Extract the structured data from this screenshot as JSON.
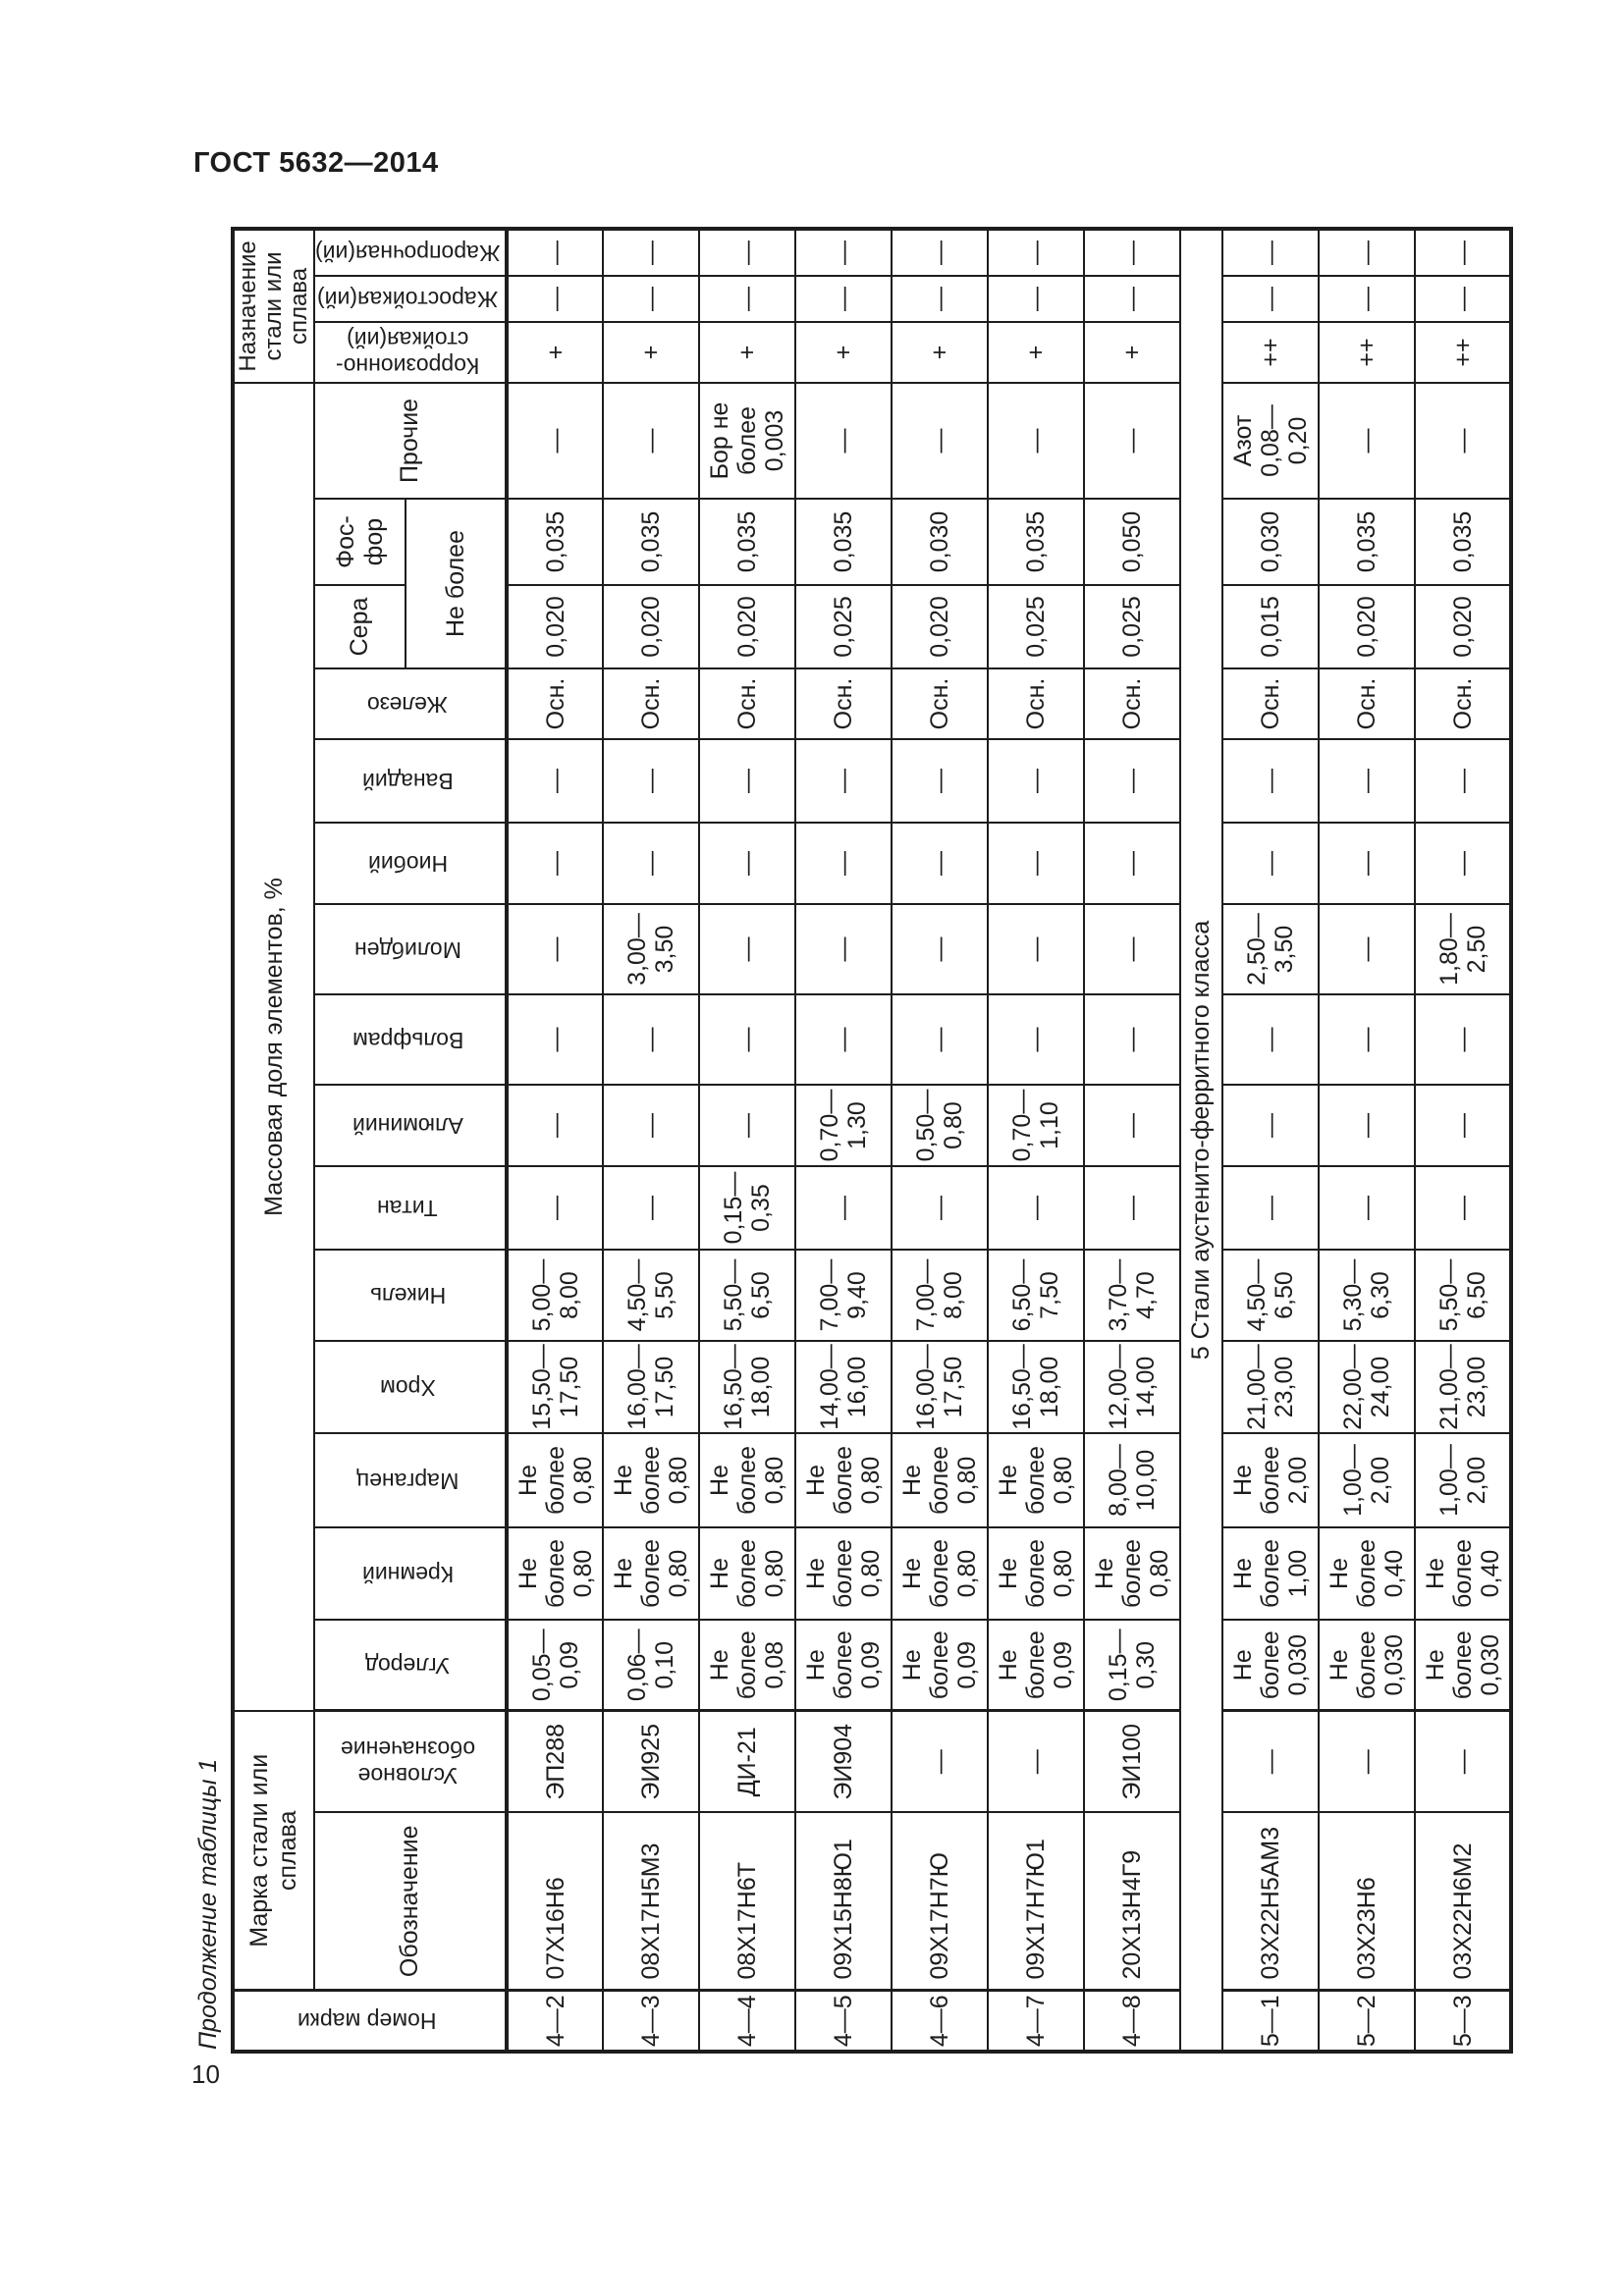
{
  "page": {
    "doc_number": "ГОСТ 5632—2014",
    "page_number": "10",
    "continuation_label": "Продолжение таблицы 1"
  },
  "table": {
    "headers": {
      "num": "Номер марки",
      "mark_group": "Марка стали или сплава",
      "oboznachenie": "Обозначение",
      "uslovnoe": "Условное\nобозначение",
      "mass_group": "Массовая доля элементов, %",
      "uglerod": "Углерод",
      "kremniy": "Кремний",
      "marganec": "Марганец",
      "hrom": "Хром",
      "nikel": "Никель",
      "titan": "Титан",
      "aluminiy": "Алюминий",
      "volfram": "Вольфрам",
      "molibden": "Молибден",
      "niobiy": "Ниобий",
      "vanadiy": "Ванадий",
      "zhelezo": "Железо",
      "sera": "Сера",
      "fosfor": "Фос-\nфор",
      "ne_bolee": "Не более",
      "prochie": "Прочие",
      "naznachenie_group": "Назначение\nстали или\nсплава",
      "korroz": "Коррозионно-\nстойкая(ий)",
      "zharostoykaya": "Жаростойкая(ий)",
      "zharoprochnaya": "Жаропрочная(ий)"
    },
    "column_keys": [
      "num",
      "mark",
      "alias",
      "c",
      "si",
      "mn",
      "cr",
      "ni",
      "ti",
      "al",
      "w",
      "mo",
      "nb",
      "v",
      "fe",
      "s",
      "p",
      "other",
      "corr",
      "heat_resistant",
      "heat_proof"
    ],
    "rows": [
      {
        "num": "4—2",
        "mark": "07Х16Н6",
        "alias": "ЭП288",
        "c": "0,05—\n0,09",
        "si": "Не\nболее\n0,80",
        "mn": "Не\nболее\n0,80",
        "cr": "15,50—\n17,50",
        "ni": "5,00—\n8,00",
        "ti": "—",
        "al": "—",
        "w": "—",
        "mo": "—",
        "nb": "—",
        "v": "—",
        "fe": "Осн.",
        "s": "0,020",
        "p": "0,035",
        "other": "—",
        "corr": "+",
        "heat_resistant": "—",
        "heat_proof": "—"
      },
      {
        "num": "4—3",
        "mark": "08Х17Н5М3",
        "alias": "ЭИ925",
        "c": "0,06—\n0,10",
        "si": "Не\nболее\n0,80",
        "mn": "Не\nболее\n0,80",
        "cr": "16,00—\n17,50",
        "ni": "4,50—\n5,50",
        "ti": "—",
        "al": "—",
        "w": "—",
        "mo": "3,00—\n3,50",
        "nb": "—",
        "v": "—",
        "fe": "Осн.",
        "s": "0,020",
        "p": "0,035",
        "other": "—",
        "corr": "+",
        "heat_resistant": "—",
        "heat_proof": "—"
      },
      {
        "num": "4—4",
        "mark": "08Х17Н6Т",
        "alias": "ДИ-21",
        "c": "Не\nболее\n0,08",
        "si": "Не\nболее\n0,80",
        "mn": "Не\nболее\n0,80",
        "cr": "16,50—\n18,00",
        "ni": "5,50—\n6,50",
        "ti": "0,15—\n0,35",
        "al": "—",
        "w": "—",
        "mo": "—",
        "nb": "—",
        "v": "—",
        "fe": "Осн.",
        "s": "0,020",
        "p": "0,035",
        "other": "Бор не\nболее\n0,003",
        "corr": "+",
        "heat_resistant": "—",
        "heat_proof": "—"
      },
      {
        "num": "4—5",
        "mark": "09Х15Н8Ю1",
        "alias": "ЭИ904",
        "c": "Не\nболее\n0,09",
        "si": "Не\nболее\n0,80",
        "mn": "Не\nболее\n0,80",
        "cr": "14,00—\n16,00",
        "ni": "7,00—\n9,40",
        "ti": "—",
        "al": "0,70—\n1,30",
        "w": "—",
        "mo": "—",
        "nb": "—",
        "v": "—",
        "fe": "Осн.",
        "s": "0,025",
        "p": "0,035",
        "other": "—",
        "corr": "+",
        "heat_resistant": "—",
        "heat_proof": "—"
      },
      {
        "num": "4—6",
        "mark": "09Х17Н7Ю",
        "alias": "—",
        "c": "Не\nболее\n0,09",
        "si": "Не\nболее\n0,80",
        "mn": "Не\nболее\n0,80",
        "cr": "16,00—\n17,50",
        "ni": "7,00—\n8,00",
        "ti": "—",
        "al": "0,50—\n0,80",
        "w": "—",
        "mo": "—",
        "nb": "—",
        "v": "—",
        "fe": "Осн.",
        "s": "0,020",
        "p": "0,030",
        "other": "—",
        "corr": "+",
        "heat_resistant": "—",
        "heat_proof": "—"
      },
      {
        "num": "4—7",
        "mark": "09Х17Н7Ю1",
        "alias": "—",
        "c": "Не\nболее\n0,09",
        "si": "Не\nболее\n0,80",
        "mn": "Не\nболее\n0,80",
        "cr": "16,50—\n18,00",
        "ni": "6,50—\n7,50",
        "ti": "—",
        "al": "0,70—\n1,10",
        "w": "—",
        "mo": "—",
        "nb": "—",
        "v": "—",
        "fe": "Осн.",
        "s": "0,025",
        "p": "0,035",
        "other": "—",
        "corr": "+",
        "heat_resistant": "—",
        "heat_proof": "—"
      },
      {
        "num": "4—8",
        "mark": "20Х13Н4Г9",
        "alias": "ЭИ100",
        "c": "0,15—\n0,30",
        "si": "Не\nболее\n0,80",
        "mn": "8,00—\n10,00",
        "cr": "12,00—\n14,00",
        "ni": "3,70—\n4,70",
        "ti": "—",
        "al": "—",
        "w": "—",
        "mo": "—",
        "nb": "—",
        "v": "—",
        "fe": "Осн.",
        "s": "0,025",
        "p": "0,050",
        "other": "—",
        "corr": "+",
        "heat_resistant": "—",
        "heat_proof": "—"
      },
      {
        "section": "5 Стали аустенито-ферритного класса"
      },
      {
        "num": "5—1",
        "mark": "03Х22Н5АМ3",
        "alias": "—",
        "c": "Не\nболее\n0,030",
        "si": "Не\nболее\n1,00",
        "mn": "Не\nболее\n2,00",
        "cr": "21,00—\n23,00",
        "ni": "4,50—\n6,50",
        "ti": "—",
        "al": "—",
        "w": "—",
        "mo": "2,50—\n3,50",
        "nb": "—",
        "v": "—",
        "fe": "Осн.",
        "s": "0,015",
        "p": "0,030",
        "other": "Азот\n0,08—\n0,20",
        "corr": "++",
        "heat_resistant": "—",
        "heat_proof": "—"
      },
      {
        "num": "5—2",
        "mark": "03Х23Н6",
        "alias": "—",
        "c": "Не\nболее\n0,030",
        "si": "Не\nболее\n0,40",
        "mn": "1,00—\n2,00",
        "cr": "22,00—\n24,00",
        "ni": "5,30—\n6,30",
        "ti": "—",
        "al": "—",
        "w": "—",
        "mo": "—",
        "nb": "—",
        "v": "—",
        "fe": "Осн.",
        "s": "0,020",
        "p": "0,035",
        "other": "—",
        "corr": "++",
        "heat_resistant": "—",
        "heat_proof": "—"
      },
      {
        "num": "5—3",
        "mark": "03Х22Н6М2",
        "alias": "—",
        "c": "Не\nболее\n0,030",
        "si": "Не\nболее\n0,40",
        "mn": "1,00—\n2,00",
        "cr": "21,00—\n23,00",
        "ni": "5,50—\n6,50",
        "ti": "—",
        "al": "—",
        "w": "—",
        "mo": "1,80—\n2,50",
        "nb": "—",
        "v": "—",
        "fe": "Осн.",
        "s": "0,020",
        "p": "0,035",
        "other": "—",
        "corr": "++",
        "heat_resistant": "—",
        "heat_proof": "—"
      }
    ]
  }
}
